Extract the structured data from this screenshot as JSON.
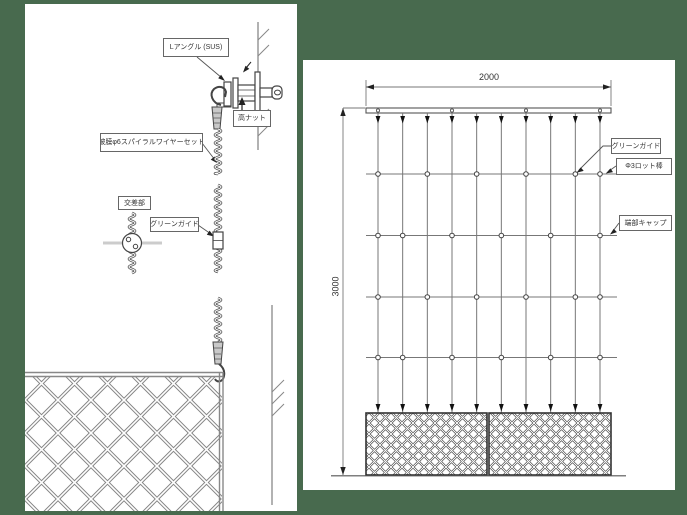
{
  "colors": {
    "background": "#486a4e",
    "paper": "#ffffff",
    "line_main": "#666666",
    "line_light": "#888888",
    "text": "#333333"
  },
  "left_panel": {
    "labels": {
      "l_angle": "Lアングル (SUS)",
      "high_nut": "高ナット",
      "spiral_wire_set": "被膜φ6スパイラルワイヤーセット",
      "intersection": "交差部",
      "green_guide": "グリーンガイド"
    }
  },
  "right_panel": {
    "dim_width": "2000",
    "dim_height": "3000",
    "labels": {
      "green_guide": "グリーンガイド",
      "rod": "Φ3ロット棒",
      "end_cap": "端部キャップ"
    },
    "grid": {
      "wire_count": 10,
      "rod_count": 4,
      "rail_hole_wires": [
        0,
        3,
        6,
        9
      ],
      "guide_wires_even_rows": [
        0,
        2,
        4,
        6,
        8,
        9
      ],
      "guide_wires_odd_rows": [
        0,
        1,
        3,
        5,
        7,
        9
      ],
      "planter_box_count": 2
    }
  }
}
